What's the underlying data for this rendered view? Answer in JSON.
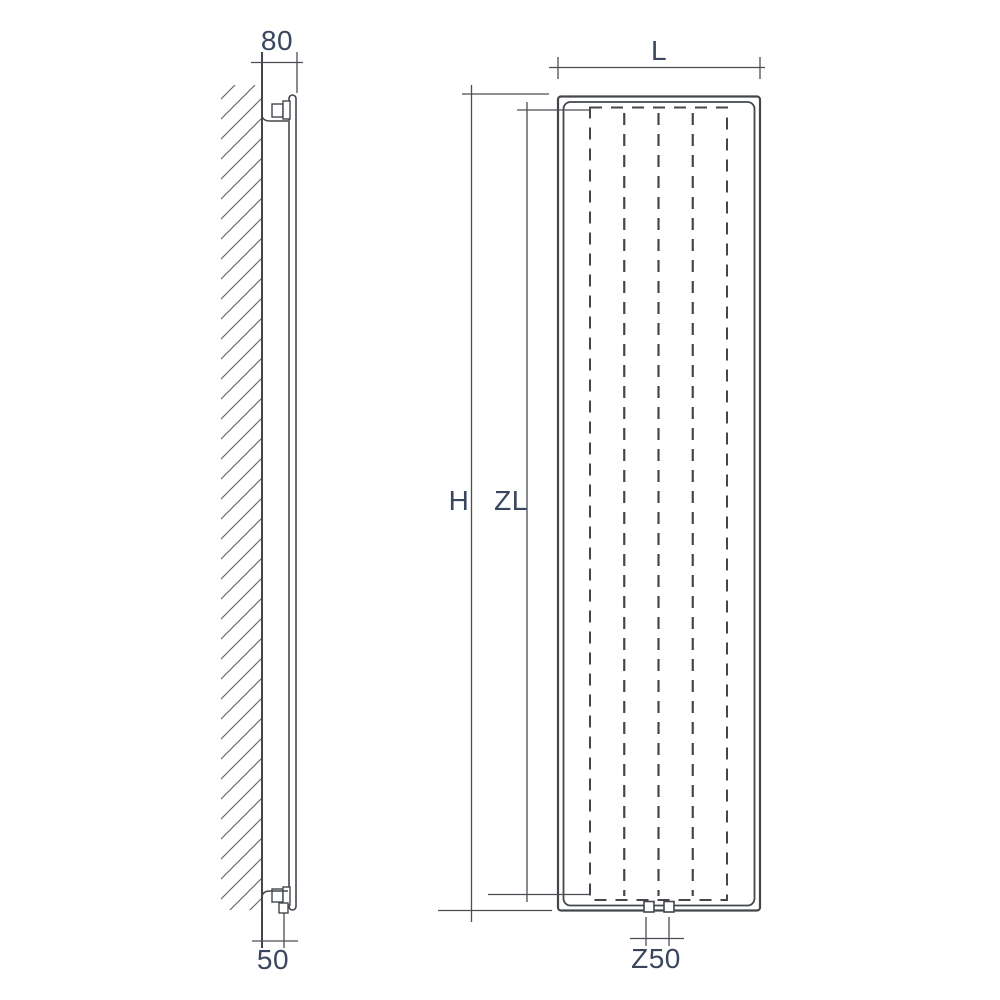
{
  "drawing": {
    "subject": "vertical-panel-radiator-dimension-drawing",
    "views": {
      "side": {
        "name": "side-view-wall-mounted",
        "dimensions": [
          {
            "id": "wall-to-panel-front-offset-top",
            "label": "80"
          },
          {
            "id": "wall-to-pipe-offset-bottom",
            "label": "50"
          }
        ]
      },
      "front": {
        "name": "front-view",
        "dimensions": [
          {
            "id": "overall-width",
            "label": "L"
          },
          {
            "id": "overall-height",
            "label": "H"
          },
          {
            "id": "element-height",
            "label": "ZL"
          },
          {
            "id": "pipe-connection-spacing",
            "label": "Z50"
          }
        ]
      }
    },
    "colors": {
      "background": "#ffffff",
      "object_line": "#43474c",
      "dimension_line": "#4a4e53",
      "label_text": "#3a455e",
      "hatch_line": "#5a6065"
    }
  }
}
